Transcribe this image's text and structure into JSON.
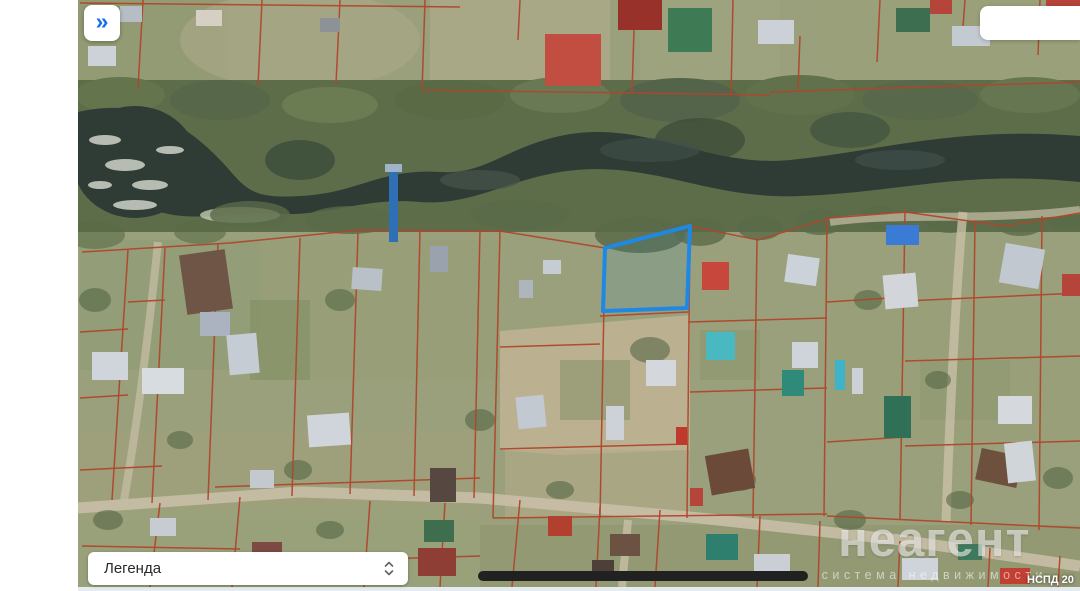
{
  "sidebar": {
    "expand_button": {
      "icon": "»",
      "icon_color": "#1a6fe8"
    }
  },
  "legend": {
    "label": "Легенда"
  },
  "watermark": {
    "brand": "неагент",
    "tagline": "система недвижимости"
  },
  "map": {
    "kind": "satellite-cadastral",
    "attribution": "НСПД 20",
    "selected_parcel": {
      "points": "605,248 690,226 687,308 603,311",
      "stroke": "#1e88e5"
    },
    "colors": {
      "cadastral_line": "#b0462b",
      "river_water": "#2f3b35",
      "road": "#c8bfa6",
      "accent_blue": "#1a6fe8"
    }
  }
}
